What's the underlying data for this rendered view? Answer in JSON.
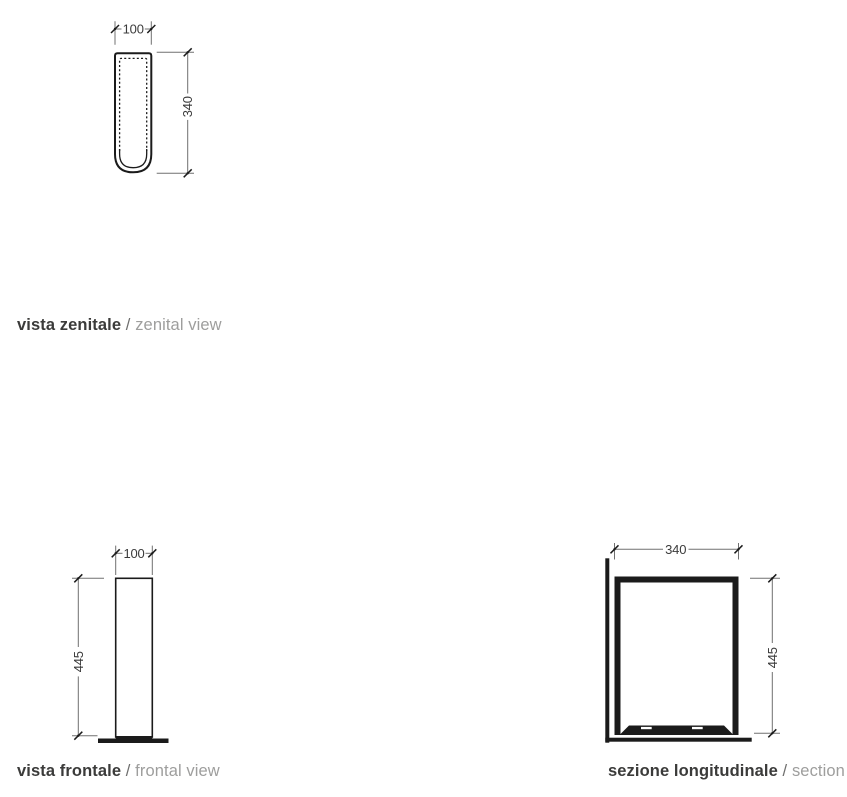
{
  "drawing": {
    "zenital": {
      "label_it": "vista zenitale",
      "sep": " / ",
      "label_en": "zenital view",
      "width_mm": "100",
      "height_mm": "340"
    },
    "frontal": {
      "label_it": "vista frontale",
      "sep": " / ",
      "label_en": "frontal view",
      "width_mm": "100",
      "height_mm": "445"
    },
    "section": {
      "label_it": "sezione longitudinale",
      "sep": " / ",
      "label_en": "section",
      "width_mm": "340",
      "height_mm": "445"
    }
  },
  "colors": {
    "shape_line": "#1b1b1b",
    "dimension_line": "#707070",
    "dimension_text": "#3b3b3b",
    "label_bold": "#3b3b3a",
    "label_gray": "#9e9e9d",
    "background": "#ffffff"
  }
}
